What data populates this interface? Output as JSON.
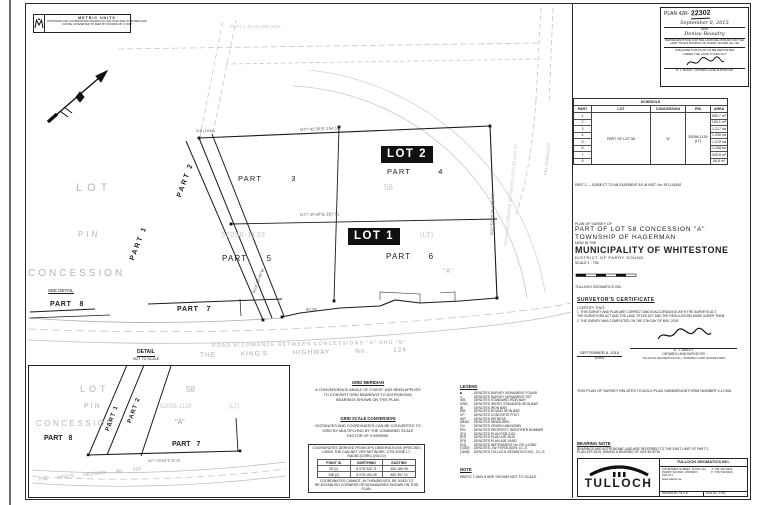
{
  "metric_box": {
    "title": "METRIC  UNITS",
    "line1": "DISTANCES AND COORDINATES SHOWN ON THIS PLAN ARE IN METRES AND",
    "line2": "CAN BE CONVERTED TO FEET BY DIVIDING BY 0.3048"
  },
  "registration": {
    "plan_label": "PLAN 42R-",
    "plan_number": "22302",
    "date": "September 8, 2015",
    "date_caption": "DATE",
    "signer": "Denise Beaudry",
    "rep_line1": "REPRESENTATIVE FOR THE LAND REGISTRAR FOR THE",
    "rep_line2": "LAND TITLES DIVISION OF PARRY SOUND (No. 42)",
    "deposit_line1": "I REQUIRE THIS PLAN TO BE DEPOSITED",
    "deposit_line2": "UNDER THE LAND TITLES ACT",
    "surveyor_line": "D. J. BAILEY, ONTARIO LAND SURVEYOR"
  },
  "schedule": {
    "title": "SCHEDULE",
    "headers": [
      "PART",
      "LOT",
      "CONCESSION",
      "PIN",
      "AREA"
    ],
    "lot_merged": "PART OF LOT 58",
    "concession_merged": "\"A\"",
    "pin_line1": "52058-1139",
    "pin_line2": "(LT)",
    "rows": [
      {
        "part": "1",
        "area": "595.7 m²"
      },
      {
        "part": "2",
        "area": "190.1 m²"
      },
      {
        "part": "3",
        "area": "1.217 ha"
      },
      {
        "part": "4",
        "area": "1.206 ha"
      },
      {
        "part": "5",
        "area": "1.219 ha"
      },
      {
        "part": "6",
        "area": "1.208 ha"
      },
      {
        "part": "7",
        "area": "325.6 m²"
      },
      {
        "part": "8",
        "area": "46.8 m²"
      }
    ]
  },
  "right_col": {
    "easement_note": "PART 2  —  SUBJECT TO AN EASEMENT AS IN INST. No. RO-141582"
  },
  "title_block": {
    "line1": "PLAN OF SURVEY OF",
    "line2": "PART OF LOT 58 CONCESSION \"A\"",
    "line3": "TOWNSHIP OF HAGERMAN",
    "line4": "NOW IN THE",
    "line5": "MUNICIPALITY OF WHITESTONE",
    "line6": "DISTRICT OF PARRY SOUND",
    "scale": "SCALE 1 : 750",
    "firm": "TULLOCH GEOMATICS INC."
  },
  "certificate": {
    "title": "SURVEYOR'S CERTIFICATE",
    "intro": "I CERTIFY THAT:",
    "item1a": "1. THIS SURVEY AND PLAN ARE CORRECT AND IN ACCORDANCE WITH THE SURVEYS ACT,",
    "item1b": "    THE SURVEYORS ACT AND THE LAND TITLES ACT AND THE REGULATIONS MADE UNDER THEM.",
    "item2": "2. THE SURVEY WAS COMPLETED ON THE 27th DAY OF MAY, 2015.",
    "date": "SEPTEMBER 8, 2015",
    "date_caption": "(DATE)",
    "name": "D. J. BAILEY",
    "name_title": "ONTARIO LAND SURVEYOR",
    "firm_line": "TULLOCH GEOMATICS INC., ONTARIO LAND SURVEYORS"
  },
  "submission_note": "THIS PLAN OF SURVEY RELATES TO AOLS PLAN SUBMISSION FORM NUMBER V-17406.",
  "bearing_note": {
    "title": "BEARING NOTE",
    "line1": "BEARINGS ARE ASTRONOMIC AND ARE REFERRED TO THE EAST LIMIT OF PART 2,",
    "line2": "PLAN 42R-2619, HAVING A BEARING OF N24°46'40\"W."
  },
  "tulloch": {
    "logo_text": "TULLOCH",
    "firm": "TULLOCH GEOMATICS INC.",
    "addr1": "105 BOWES STREET, SUITE 101",
    "addr2": "PARRY SOUND, ONTARIO",
    "addr3": "P2A 2L7",
    "phone": "T: 705-746-9343",
    "fax": "F: 705-746-9344",
    "web": "www.tulloch.ca",
    "drawn": "DRAWN BY: M.A.P.",
    "file": "FILE No. 7702"
  },
  "drawing": {
    "lot2": "LOT 2",
    "lot1": "LOT 1",
    "part3": "PART 3",
    "part4": "PART 4",
    "part5": "PART 5",
    "part6": "PART 6",
    "part7": "PART 7",
    "part8": "PART 8",
    "part1_v": "PART 1",
    "part2_v": "PART 2",
    "lot_big": "LOT",
    "pin_big": "PIN",
    "concession_big": "CONCESSION",
    "see_detail": "SEE DETAIL",
    "pin_num": "52058-1139",
    "lt": "(LT)",
    "lot58": "58",
    "quote_a": "\"A\"",
    "road_allowance": "ROAD ALLOWANCE BETWEEN CONCESSIONS \"A\" AND \"B\"",
    "highway": "THE  KING'S  HIGHWAY  No. 124",
    "faint_top": "PART 1, PLAN 42R-2619",
    "pin_right_v": "PIN 52058-0223",
    "road_right_v": "ROAD ALLOWANCE BETWEEN LOTS 55 AND 56"
  },
  "annotations": {
    "a1": "N77°42'30\"E   294.17",
    "a2": "N77°40'50\"E   267.51",
    "a3": "N12°51'20\"W   171.77",
    "a4": "N24°46'40\"W",
    "a5": "60.96",
    "a6": "SIB (1836)"
  },
  "detail_inset": {
    "label": "DETAIL",
    "sublabel": "NOT TO SCALE",
    "lot": "LOT",
    "lot_num": "58",
    "pin": "PIN",
    "pin_num": "52058-1139",
    "lt": "(LT)",
    "concession": "CONCESSION",
    "quote_a": "\"A\"",
    "part8": "PART 8",
    "part7": "PART 7",
    "part1": "PART 1",
    "part2": "PART 2",
    "highway": "THE KING'S HIGHWAY No. 124",
    "ann": "N77°40'50\"E  32.61"
  },
  "notes": {
    "grid_meridian_title": "GRID MERIDIAN",
    "gm1": "A CONVERGENCE ANGLE OF 0°48'20\" HAS BEEN APPLIED",
    "gm2": "TO CONVERT GRID BEARINGS TO ASTRONOMIC",
    "gm3": "BEARINGS SHOWN ON THIS PLAN.",
    "grid_scale_title": "GRID SCALE CONVERSION",
    "gs1": "DISTANCES AND COORDINATES CAN BE CONVERTED TO",
    "gs2": "GRID BY MULTIPLYING BY THE COMBINED SCALE",
    "gs3": "FACTOR OF 0.9999595.",
    "coord_header1": "COORDINATES DERIVED FROM GPS OBSERVATIONS (PRECISE)",
    "coord_header2": "USING THE CAN-NET VRS NETWORK.  UTM ZONE 17,",
    "coord_header3": "NAD83 (CSRS) (2010.0)",
    "coord_cols": [
      "POINT ID",
      "NORTHING",
      "EASTING"
    ],
    "coord_rows": [
      {
        "id": "IB (1)",
        "n": "5 078 342.71",
        "e": "482 185.99"
      },
      {
        "id": "SIB (2)",
        "n": "5 078 154.05",
        "e": "482 357.12"
      }
    ],
    "coord_footer1": "COORDINATES CANNOT, IN THEMSELVES, BE USED TO",
    "coord_footer2": "RE-ESTABLISH CORNERS OR BOUNDARIES SHOWN ON THIS PLAN."
  },
  "legend": {
    "title": "LEGEND",
    "rows": [
      {
        "s": "■",
        "d": "DENOTES SURVEY MONUMENT FOUND"
      },
      {
        "s": "□",
        "d": "DENOTES SURVEY MONUMENT SET"
      },
      {
        "s": "SIB",
        "d": "DENOTES STANDARD IRON BAR"
      },
      {
        "s": "SSIB",
        "d": "DENOTES SHORT STANDARD IRON BAR"
      },
      {
        "s": "IB",
        "d": "DENOTES IRON BAR"
      },
      {
        "s": "RIB",
        "d": "DENOTES ROUND IRON BAR"
      },
      {
        "s": "CP",
        "d": "DENOTES CONCRETE POST"
      },
      {
        "s": "WIT",
        "d": "DENOTES WITNESS"
      },
      {
        "s": "MEAS",
        "d": "DENOTES MEASURED"
      },
      {
        "s": "OU",
        "d": "DENOTES ORIGIN UNKNOWN"
      },
      {
        "s": "PIN",
        "d": "DENOTES PROPERTY IDENTIFIER NUMBER"
      },
      {
        "s": "(P1)",
        "d": "DENOTES PLAN PSR-2119"
      },
      {
        "s": "(P2)",
        "d": "DENOTES PLAN 42R-2619"
      },
      {
        "s": "(P3)",
        "d": "DENOTES PLAN 42R-19492"
      },
      {
        "s": "(D1)",
        "d": "DENOTES INSTRUMENT No. RO-141582"
      },
      {
        "s": "(1492)",
        "d": "DENOTES J.W. FERGUSON, O.L.S."
      },
      {
        "s": "(1836)",
        "d": "DENOTES TULLOCH GEOMATICS INC., O.L.S."
      }
    ]
  },
  "note_block": {
    "title": "NOTE",
    "line": "PARTS 7 AND 8 ARE SHOWN NOT TO SCALE."
  }
}
